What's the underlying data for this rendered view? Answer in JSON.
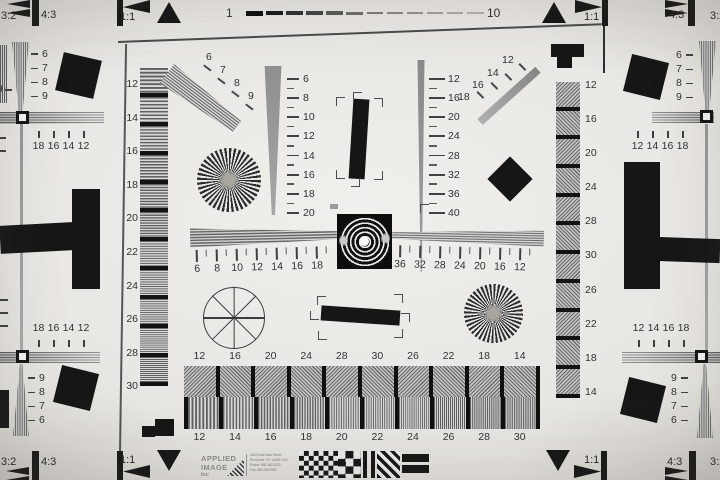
{
  "header": {
    "ruler_start": "1",
    "ruler_end": "10",
    "dash_count": 12,
    "left": {
      "r32": "3:2",
      "r43": "4:3",
      "r11": "1:1"
    },
    "right": {
      "r11": "1:1",
      "r43": "4:3",
      "r32": "3:2"
    }
  },
  "footer_marks": {
    "left": {
      "r32": "3:2",
      "r43": "4:3",
      "r11": "1:1"
    },
    "right": {
      "r11": "1:1",
      "r43": "4:3",
      "r32": "3:2"
    }
  },
  "left_edge": {
    "partial_digit": "9",
    "top_wedge_labels": [
      "6",
      "7",
      "8",
      "9"
    ],
    "upper_row": [
      "18",
      "16",
      "14",
      "12"
    ],
    "lower_row": [
      "18",
      "16",
      "14",
      "12"
    ],
    "bottom_wedge_labels": [
      "9",
      "8",
      "7",
      "6"
    ]
  },
  "right_edge": {
    "top_wedge_labels": [
      "6",
      "7",
      "8",
      "9"
    ],
    "upper_row": [
      "12",
      "14",
      "16",
      "18"
    ],
    "lower_row": [
      "12",
      "14",
      "16",
      "18"
    ],
    "bottom_wedge_labels": [
      "9",
      "8",
      "7",
      "6"
    ]
  },
  "left_column": {
    "labels": [
      "12",
      "14",
      "16",
      "18",
      "20",
      "22",
      "24",
      "26",
      "28",
      "30"
    ],
    "cell_count": 11
  },
  "right_column": {
    "labels": [
      "12",
      "16",
      "20",
      "24",
      "28",
      "30",
      "26",
      "22",
      "18",
      "14"
    ],
    "cell_count": 11
  },
  "center": {
    "fan_upper_left_labels": [
      "6",
      "7",
      "8",
      "9"
    ],
    "scale_left_labels": [
      "6",
      "8",
      "10",
      "12",
      "14",
      "16",
      "18",
      "20"
    ],
    "scale_right_labels": [
      "12",
      "16",
      "20",
      "24",
      "28",
      "32",
      "36",
      "40"
    ],
    "fan_upper_right_labels": [
      "12",
      "14",
      "16",
      "18"
    ],
    "hruler_left_labels": [
      "6",
      "8",
      "10",
      "12",
      "14",
      "16",
      "18"
    ],
    "hruler_right_labels": [
      "36",
      "32",
      "28",
      "24",
      "20",
      "16",
      "12"
    ]
  },
  "bottom_strip": {
    "top_labels": [
      "12",
      "16",
      "20",
      "24",
      "28",
      "30",
      "26",
      "22",
      "18",
      "14"
    ],
    "bottom_labels": [
      "12",
      "14",
      "16",
      "18",
      "20",
      "22",
      "24",
      "26",
      "28",
      "30"
    ],
    "cell_count": 10
  },
  "logo": {
    "line1": "APPLIED",
    "line2": "IMAGE",
    "line3": "Inc",
    "address_lines": [
      "1653 East Main Street",
      "Rochester, NY 14609 USA",
      "Phone: 585 482 0300",
      "Fax: 585 288 5989"
    ]
  }
}
